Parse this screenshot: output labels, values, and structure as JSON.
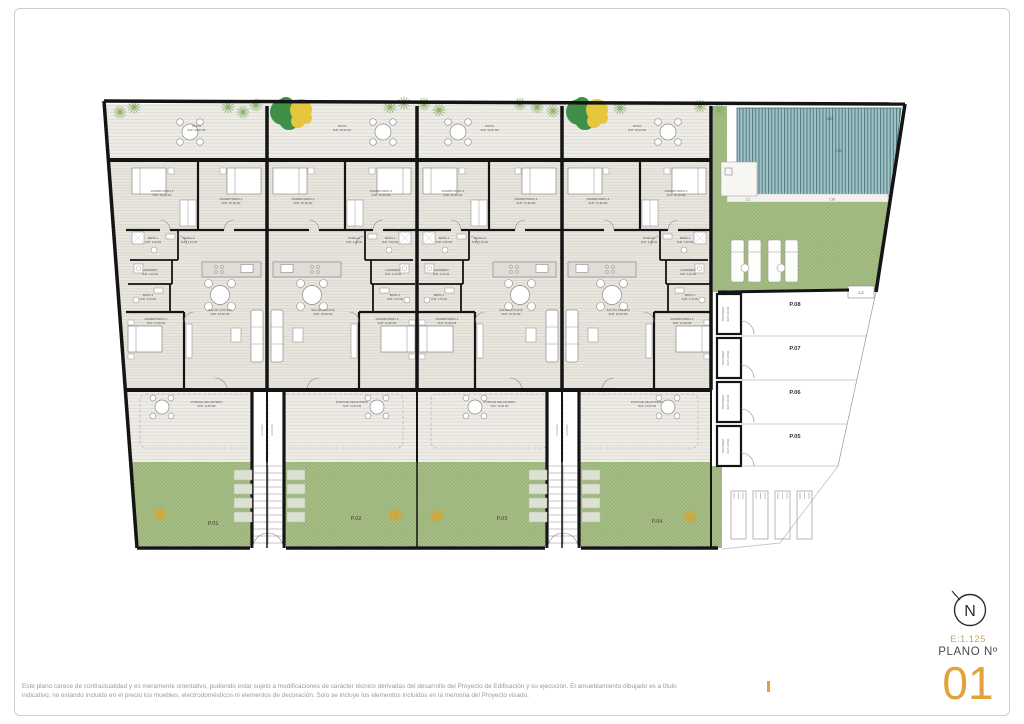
{
  "titleblock": {
    "north_letter": "N",
    "scale": "E:1.125",
    "plano_label": "PLANO Nº",
    "plano_number": "01",
    "accent_color": "#E0A33A"
  },
  "footer": {
    "line1": "Este plano carece de contractualidad y es meramente orientativo, pudiendo estar sujeto a modificaciones de carácter técnico derivadas del desarrollo del Proyecto de Edificación y su ejecución. El amueblamiento dibujado es a título",
    "line2": "indicativo; no estando incluido en el precio los muebles, electrodomésticos ni elementos de decoración. Solo se incluye los elementos incluidos en la memoria del Proyecto visado."
  },
  "plan": {
    "room_labels": {
      "patio": [
        "PATIO",
        "SUP: 30,20 M2"
      ],
      "dorm2": [
        "DORMITORIO 2",
        "SUP: 10,30 M2"
      ],
      "dorm3": [
        "DORMITORIO 3",
        "SUP: 10,90 M2"
      ],
      "bano1": [
        "BAÑO 1",
        "SUP: 3,90 M2"
      ],
      "pasillo": [
        "PASILLO",
        "SUP: 3,10 M2"
      ],
      "lavadero": [
        "LAVADERO",
        "SUP: 2,10 M2"
      ],
      "bano2": [
        "BAÑO 2",
        "SUP: 3,70 M2"
      ],
      "dorm1": [
        "DORMITORIO 1",
        "SUP: 11,90 M2"
      ],
      "salon": [
        "SALÓN-COCINA",
        "SUP: 24,60 M2"
      ],
      "porche": [
        "PORCHE DELANTERO",
        "SUP: 14,90 M2"
      ],
      "trastero": [
        "TRASTERO",
        "SUP: 2,50 M2"
      ],
      "stair": "ACCESO"
    },
    "garden_parcels": [
      "P.01",
      "P.02",
      "P.03",
      "P.04"
    ],
    "parking_parcels": [
      "P.08",
      "P.07",
      "P.06",
      "P.05"
    ],
    "pool_dims": [
      "4,87",
      "7,20",
      "7,36",
      "3,1"
    ],
    "dim_small": "1,2",
    "colors": {
      "wall": "#141414",
      "green": "#abc28b",
      "green_line": "#8ea96c",
      "pool": "#a3c4c6",
      "pool_line": "#527e86",
      "floor": "#e9e6df",
      "floor_line": "#d6d2c9",
      "gold": "#d9a62e",
      "tree_green": "#3f8f49",
      "tree_yellow": "#e6c63c"
    }
  }
}
